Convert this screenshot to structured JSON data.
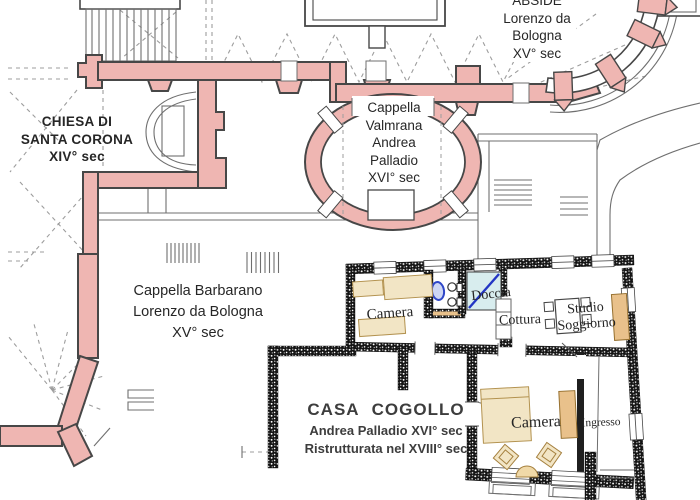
{
  "document": {
    "type": "architectural floor plan",
    "subject": "Chiesa di Santa Corona and Casa Cogollo, Vicenza"
  },
  "colors": {
    "church_wall_pink": "#efb6b2",
    "wall_outline": "#474747",
    "thin_line": "#6f6f6f",
    "dashed_line": "#9d9d9d",
    "casa_wall_black": "#141414",
    "doccia_blue_fill": "#d8edee",
    "doccia_diagonal_blue": "#2336c4",
    "fixture_blue": "#2e46c8",
    "furniture_light_tan": "#f2e5c5",
    "furniture_dark_tan": "#e9c18b",
    "label_text": "#262626"
  },
  "labels": {
    "chiesa": {
      "lines": [
        "CHIESA DI",
        "SANTA CORONA",
        "XIV° sec"
      ]
    },
    "abside": {
      "lines": [
        "ABSIDE",
        "Lorenzo da",
        "Bologna",
        "XV° sec"
      ]
    },
    "valmarana": {
      "lines": [
        "Cappella",
        "Valmrana",
        "Andrea",
        "Palladio",
        "XVI° sec"
      ]
    },
    "barbarano": {
      "lines": [
        "Cappella Barbarano",
        "Lorenzo da Bologna",
        "XV° sec"
      ]
    },
    "casa": {
      "title": "CASA COGOLLO",
      "line2": "Andrea Palladio XVI° sec",
      "line3": "Ristrutturata nel XVIII° sec"
    }
  },
  "rooms": {
    "camera_upper": "Camera",
    "doccia": "Doccia",
    "cottura": "Cottura",
    "studio_line1": "Studio",
    "studio_line2": "Soggiorno",
    "camera_lower": "Camera",
    "ingresso": "Ingresso"
  }
}
